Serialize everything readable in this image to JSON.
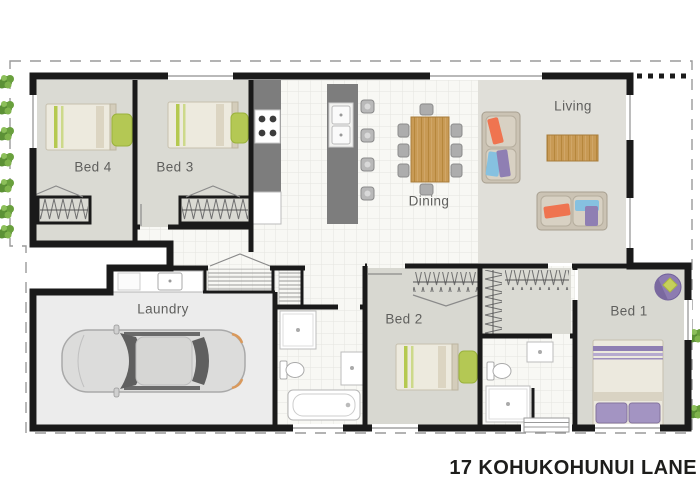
{
  "address_label": "17 KOHUKOHUNUI LANE",
  "rooms": {
    "bed4": {
      "label": "Bed 4"
    },
    "bed3": {
      "label": "Bed 3"
    },
    "dining": {
      "label": "Dining"
    },
    "living": {
      "label": "Living"
    },
    "laundry": {
      "label": "Laundry"
    },
    "bed2": {
      "label": "Bed 2"
    },
    "bed1": {
      "label": "Bed 1"
    }
  },
  "fixtures": [
    "car-top-view",
    "dining-table-8-chairs",
    "sofa",
    "sofa",
    "coffee-table",
    "single-bed",
    "single-bed",
    "single-bed",
    "double-bed",
    "round-chair",
    "kitchen-island-sink",
    "cooktop",
    "bar-stools",
    "bathtub",
    "toilet",
    "toilet",
    "shower",
    "shower",
    "vanity",
    "laundry-tub",
    "wardrobe-rails",
    "linen-shelves",
    "entry-steps",
    "boundary-dashed-line",
    "fence-dotted-line",
    "garden-plants"
  ],
  "colors": {
    "wall": "#1a1a1a",
    "carpet": "#dadad3",
    "living_carpet": "#e0dfd9",
    "tile": "#f8f8f4",
    "tile_grid": "#e5e5df",
    "counter_gray": "#7d7d7d",
    "wood": "#c89a55",
    "lime_accent": "#b5c94f",
    "orange_accent": "#ef7450",
    "blue_accent": "#86c1e0",
    "purple_accent": "#8f7fb3",
    "garage_floor": "#ececec",
    "plant_green": "#5f923c",
    "boundary_dash": "#9a9a9a",
    "label_text": "#5f5f5d",
    "address_text": "#1d1d1b"
  }
}
